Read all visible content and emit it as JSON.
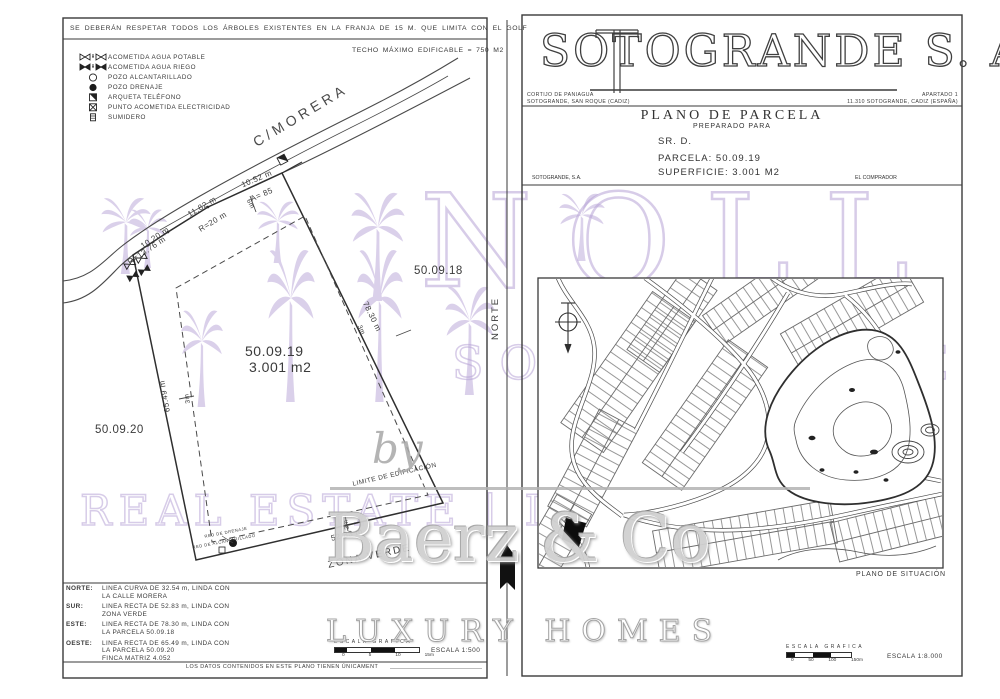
{
  "colors": {
    "ink": "#3a3a3a",
    "purple": "#b7a3d6",
    "gray_wm": "#c9c9c9",
    "black": "#111111"
  },
  "left_panel": {
    "note_top": "SE DEBERÁN RESPETAR TODOS LOS ÁRBOLES EXISTENTES EN LA FRANJA DE 15 M. QUE LIMITA CON EL GOLF",
    "techo": "TECHO MÁXIMO EDIFICABLE = 750 M2",
    "legend": {
      "items": [
        {
          "icon": "water-supply-icon",
          "label": "ACOMETIDA AGUA POTABLE"
        },
        {
          "icon": "irrigation-supply-icon",
          "label": "ACOMETIDA AGUA RIEGO"
        },
        {
          "icon": "manhole-icon",
          "label": "POZO ALCANTARILLADO"
        },
        {
          "icon": "drain-well-icon",
          "label": "POZO DRENAJE"
        },
        {
          "icon": "phone-box-icon",
          "label": "ARQUETA TELÉFONO"
        },
        {
          "icon": "electric-point-icon",
          "label": "PUNTO ACOMETIDA ELECTRICIDAD"
        },
        {
          "icon": "gully-icon",
          "label": "SUMIDERO"
        }
      ]
    },
    "street_label": "C/MORERA",
    "parcel": {
      "number": "50.09.19",
      "area": "3.001 m2"
    },
    "neighbor_east": "50.09.18",
    "neighbor_west": "50.09.20",
    "meas": {
      "n1": "10.20 m",
      "n1r": "R=13.76 m",
      "n2": "11.82 m",
      "n2r": "R=20 m",
      "n3": "10.52 m",
      "n3a": "A= 85",
      "set_n": "6m",
      "set_e": "3m",
      "set_w": "3m",
      "set_s": "3m",
      "east": "78.30 m",
      "west": "65.49 m",
      "south": "52.83 m",
      "limite": "LIMITE DE EDIFICACIÓN",
      "zona": "ZONA VERDE",
      "red_drenaje": "RED DE DRENAJE",
      "red_alcantarillado": "RED DE ALCANTARILLADO"
    },
    "norte_label": "NORTE",
    "directions": [
      {
        "label": "NORTE:",
        "line1": "LINEA CURVA DE 32.54 m, LINDA CON",
        "line2": "LA CALLE MORERA",
        "line3": ""
      },
      {
        "label": "SUR:",
        "line1": "LINEA RECTA DE 52.83 m, LINDA CON",
        "line2": "ZONA VERDE",
        "line3": ""
      },
      {
        "label": "ESTE:",
        "line1": "LINEA RECTA DE 78.30 m, LINDA CON",
        "line2": "LA PARCELA 50.09.18",
        "line3": ""
      },
      {
        "label": "OESTE:",
        "line1": "LINEA RECTA DE 65.49 m, LINDA CON",
        "line2": "LA PARCELA 50.09.20",
        "line3": "FINCA MATRIZ 4.052"
      }
    ],
    "footer": "LOS DATOS CONTENIDOS EN ESTE PLANO TIENEN ÚNICAMENT",
    "scale": {
      "title": "ESCALA GRAFICA",
      "ticks": [
        "0",
        "5",
        "10",
        "15m"
      ],
      "value": "ESCALA 1:500"
    }
  },
  "right_panel": {
    "company": {
      "name": "SOTOGRANDE  S. A.",
      "addr_left1": "CORTIJO DE PANIAGUA",
      "addr_left2": "SOTOGRANDE, SAN ROQUE (CADIZ)",
      "addr_right1": "APARTADO 1",
      "addr_right2": "11.310 SOTOGRANDE, CADIZ (ESPAÑA)"
    },
    "title_block": {
      "title": "PLANO DE PARCELA",
      "subtitle": "PREPARADO PARA",
      "client": "SR. D.",
      "parcela": "PARCELA:  50.09.19",
      "superficie": "SUPERFICIE:  3.001 M2",
      "sig_left": "SOTOGRANDE, S.A.",
      "sig_right": "EL COMPRADOR"
    },
    "map_caption": "PLANO DE SITUACIÓN",
    "scale": {
      "title": "ESCALA GRAFICA",
      "ticks": [
        "0",
        "50",
        "100",
        "150m"
      ],
      "value": "ESCALA 1:8.000"
    }
  },
  "watermark": {
    "brand": "NOLL",
    "brand_sub": "SOTOGRANDE",
    "line2": "REAL ESTATE | INMOBILIARIA",
    "by": "by",
    "name": "Baerz & Co",
    "tagline": "LUXURY HOMES"
  }
}
